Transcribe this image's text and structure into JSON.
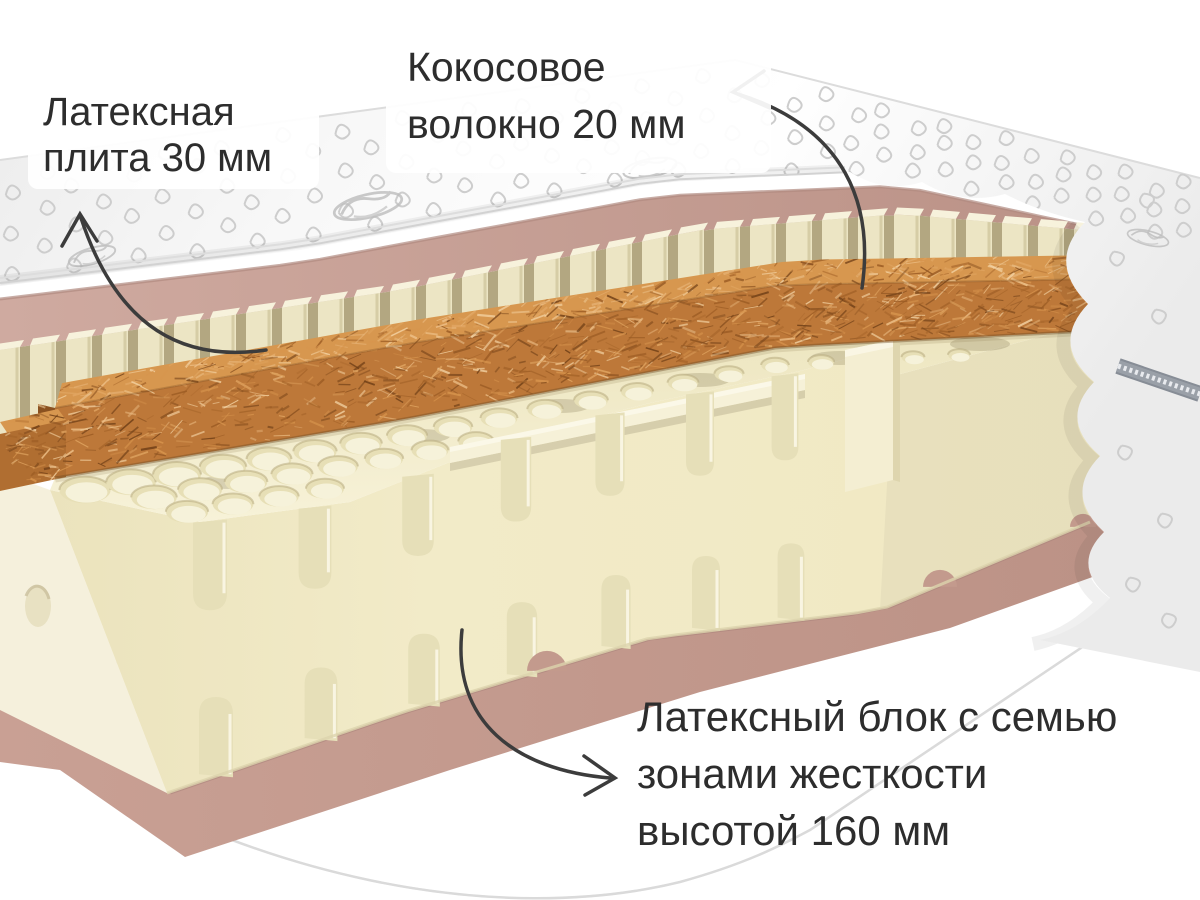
{
  "annotations": {
    "latex_plate": {
      "line1": "Латексная",
      "line2": "плита 30 мм"
    },
    "coconut_fiber": {
      "line1": "Кокосовое",
      "line2": "волокно 20 мм"
    },
    "latex_block": {
      "line1": "Латексный блок с семью",
      "line2": "зонами жесткости",
      "line3": "высотой 160 мм"
    }
  },
  "layers": [
    {
      "name": "Латексная плита",
      "thickness_mm": 30
    },
    {
      "name": "Кокосовое волокно",
      "thickness_mm": 20
    },
    {
      "name": "Латексный блок",
      "height_mm": 160,
      "hardness_zones": 7
    }
  ],
  "colors": {
    "background": "#ffffff",
    "cover_white": "#f7f7f7",
    "cover_shade": "#e9e9e9",
    "quilt_stitch": "#cdcdcd",
    "logo_gray": "#bdbdbd",
    "fabric_pink": "#c6a096",
    "fabric_pink_dark": "#b08a80",
    "base_pink": "#c39a8d",
    "slat_cream": "#ece5c4",
    "slat_gap": "#b3a781",
    "slat_cap": "#f7f2dc",
    "block_front": "#f0e9c5",
    "block_top": "#f2ecca",
    "block_left": "#f5f0dc",
    "slot_shade": "#e6dfb8",
    "hole_dark": "#e7dfb6",
    "hole_light": "#f6f2da",
    "coir_top": "#d7974f",
    "coir_front": "#bd7839",
    "coir_dark": "#8a5120",
    "zipper_gray": "#9aa0a8",
    "arrow": "#3c3c3c",
    "text": "#2d2d2d"
  }
}
